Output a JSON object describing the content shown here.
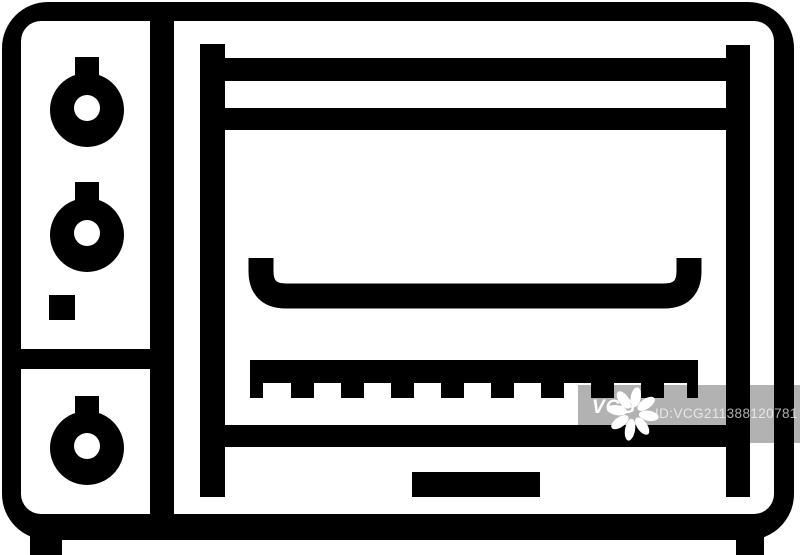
{
  "image": {
    "subject": "toaster oven line icon",
    "background_color": "#ffffff",
    "icon_color": "#000000"
  },
  "watermark": {
    "logo": "VCG",
    "id_text": "ID:VCG211388120781",
    "band_color": "rgba(0,0,0,0.30)",
    "text_color": "#ffffff",
    "star_icon": "vcg-starburst"
  }
}
